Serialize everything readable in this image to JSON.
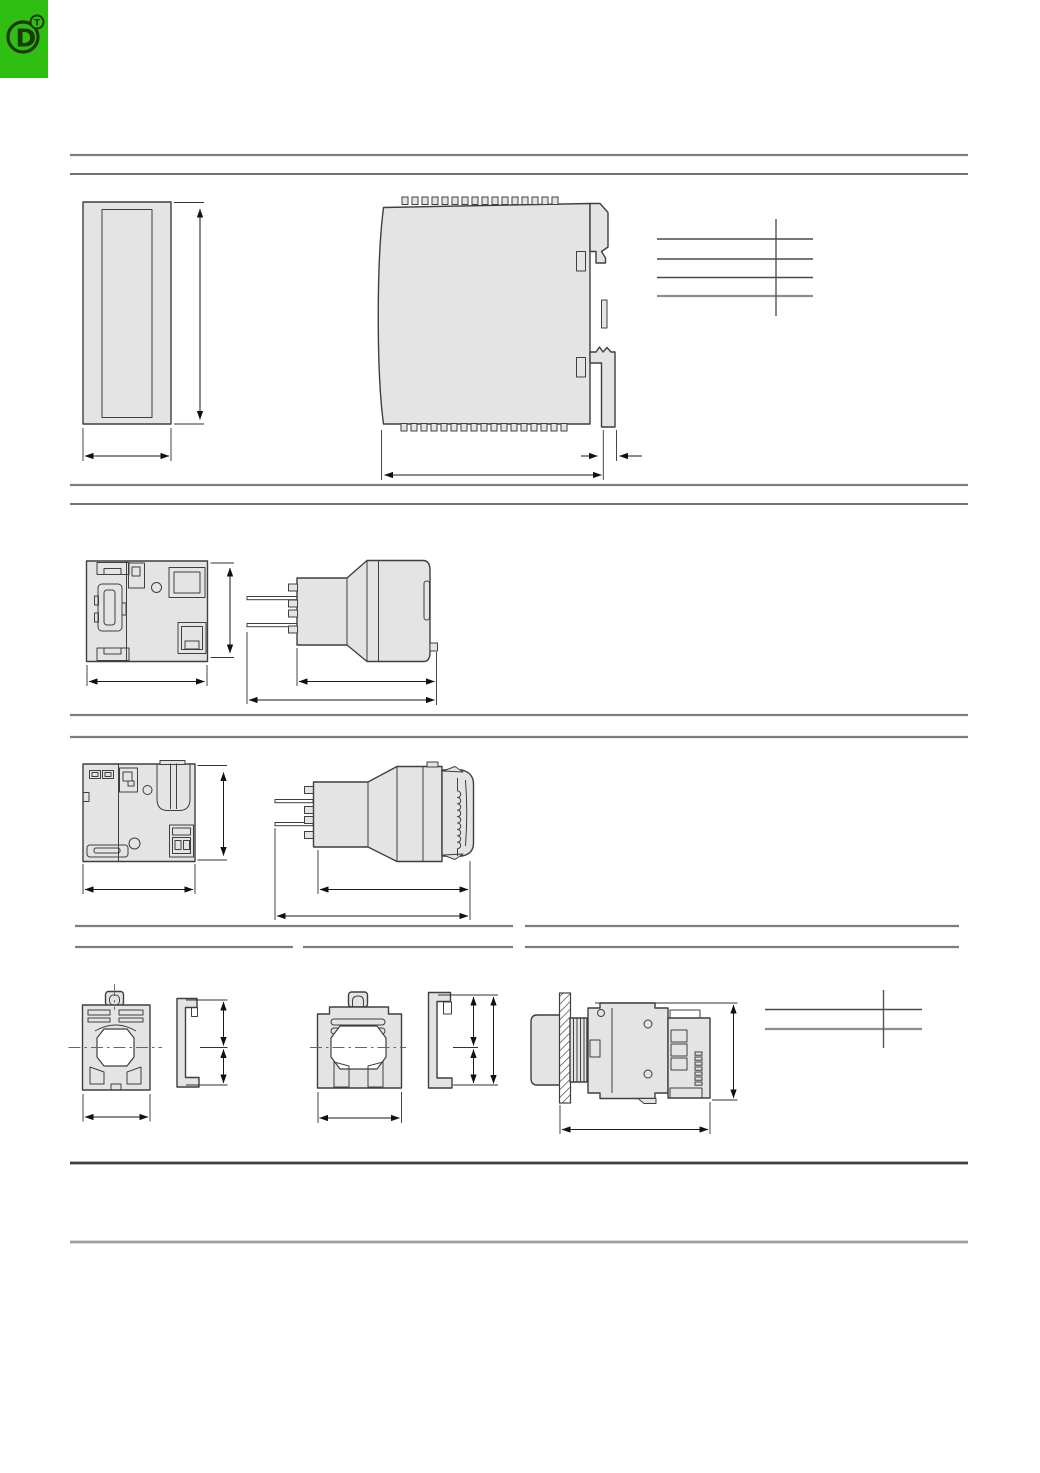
{
  "page": {
    "width": 1040,
    "height": 1473,
    "background": "#ffffff"
  },
  "logo": {
    "letter": "D",
    "mark": "T"
  },
  "palette": {
    "white": "#ffffff",
    "fill": "#e4e4e4",
    "stroke": "#3f3f3f",
    "dim": "#1a1a1a",
    "ext": "#333333",
    "rule-gray": "#7d7d7d",
    "rule-dark": "#3f3f3f",
    "rule-light": "#9f9f9f",
    "logo-bg": "#2ebf12",
    "logo-fg": "#1c3a06"
  }
}
